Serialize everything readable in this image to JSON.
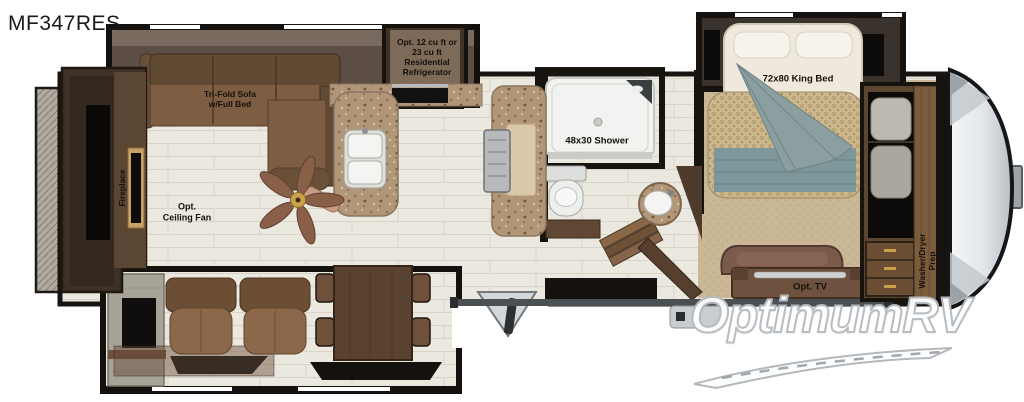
{
  "header": {
    "model": "MF347RES"
  },
  "floorplan": {
    "living": {
      "sofa_label": "Tri-Fold Sofa\nw/Full Bed",
      "fireplace_label": "Fireplace",
      "ceiling_fan_label": "Opt.\nCeiling Fan"
    },
    "kitchen": {
      "refrigerator_label": "Opt. 12 cu ft or\n23 cu ft\nResidential\nRefrigerator"
    },
    "bathroom": {
      "shower_label": "48x30 Shower"
    },
    "bedroom": {
      "bed_label": "72x80 King Bed",
      "tv_label": "Opt. TV",
      "washer_dryer_label": "Washer/Dryer\nPrep"
    }
  },
  "watermark": {
    "brand": "OptimumRV"
  }
}
